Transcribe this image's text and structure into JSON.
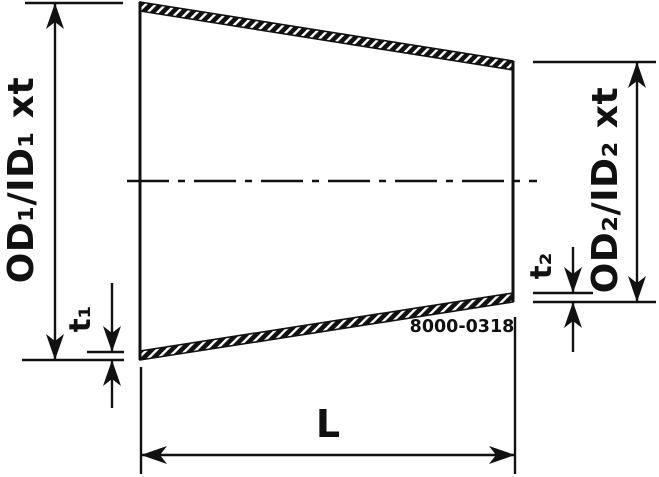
{
  "drawing": {
    "background_color": "#ffffff",
    "line_color": "#111111",
    "labels": {
      "od1": "OD₁/ID₁ xt",
      "od2": "OD₂/ID₂ xt",
      "t1": "t₁",
      "t2": "t₂",
      "length": "L",
      "part_number": "8000-0318"
    }
  }
}
